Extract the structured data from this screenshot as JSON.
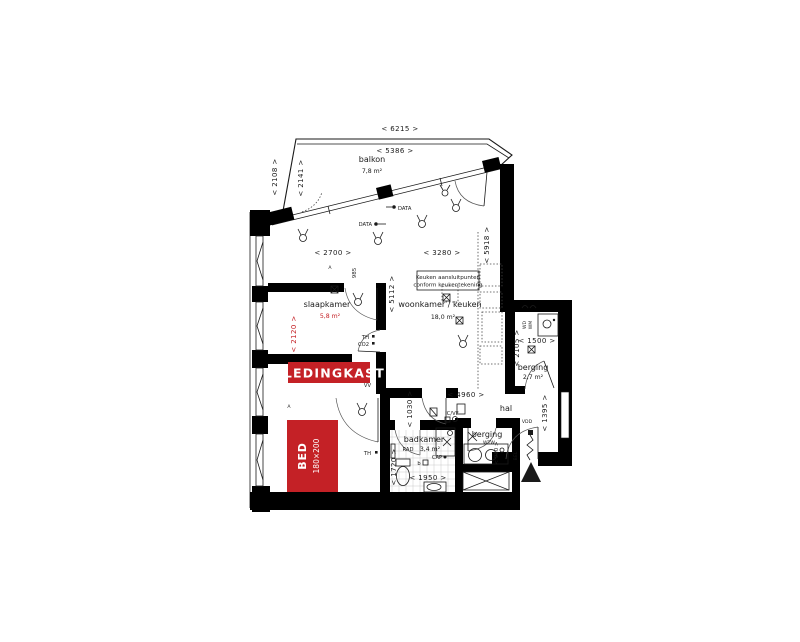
{
  "colors": {
    "accent_red": "#c42126",
    "wall": "#000000",
    "background": "#ffffff"
  },
  "rooms": {
    "balkon": {
      "label": "balkon",
      "area": "7,8 m²"
    },
    "slaapkamer": {
      "label": "slaapkamer",
      "area": "5,8 m²"
    },
    "woonkamer": {
      "label": "woonkamer / keuken",
      "area": "18,0 m²"
    },
    "badkamer": {
      "label": "badkamer",
      "area": "3,4 m²"
    },
    "berging_klein": {
      "label": "berging"
    },
    "berging_rechts": {
      "label": "berging",
      "area": "2,7 m²"
    },
    "hal": {
      "label": "hal"
    }
  },
  "furniture": {
    "bed": {
      "label": "BED",
      "size": "180×200"
    },
    "kledingkast": {
      "label": "KLEDINGKAST"
    }
  },
  "note": {
    "line1": "Keuken aansluitpunten",
    "line2": "conform keukentekening"
  },
  "dims": {
    "w6215": "<  6215  >",
    "w5386": "<  5386  >",
    "v2108": "<  2108  >",
    "v2141": "<  2141  >",
    "w2700": "<  2700  >",
    "w3280": "<  3280  >",
    "v5918": "<  5918  >",
    "v5112": "<  5112  >",
    "v985": "985",
    "v2120": "<  2120  >",
    "w4960": "<  4960  >",
    "v1030": "<  1030  >",
    "w1500": "<  1500  >",
    "v2105": "<  2105  >",
    "v1395": "<  1395  >",
    "v980": "< 980 >",
    "v1720": "<  1720  >",
    "w1950": "<  1950  >"
  },
  "tags": {
    "data1": "DATA",
    "data2": "DATA",
    "th1": "TH",
    "co2": "CO2",
    "vv": "VV",
    "icvf": "IC/VF",
    "rad": "RAD",
    "cap": "CAP",
    "wtw": "WTW",
    "vdd": "VDD",
    "bel": "BEL",
    "wd": "WD",
    "wm": "WM",
    "th2": "TH",
    "b": "b",
    "a1": "A",
    "a2": "A"
  }
}
